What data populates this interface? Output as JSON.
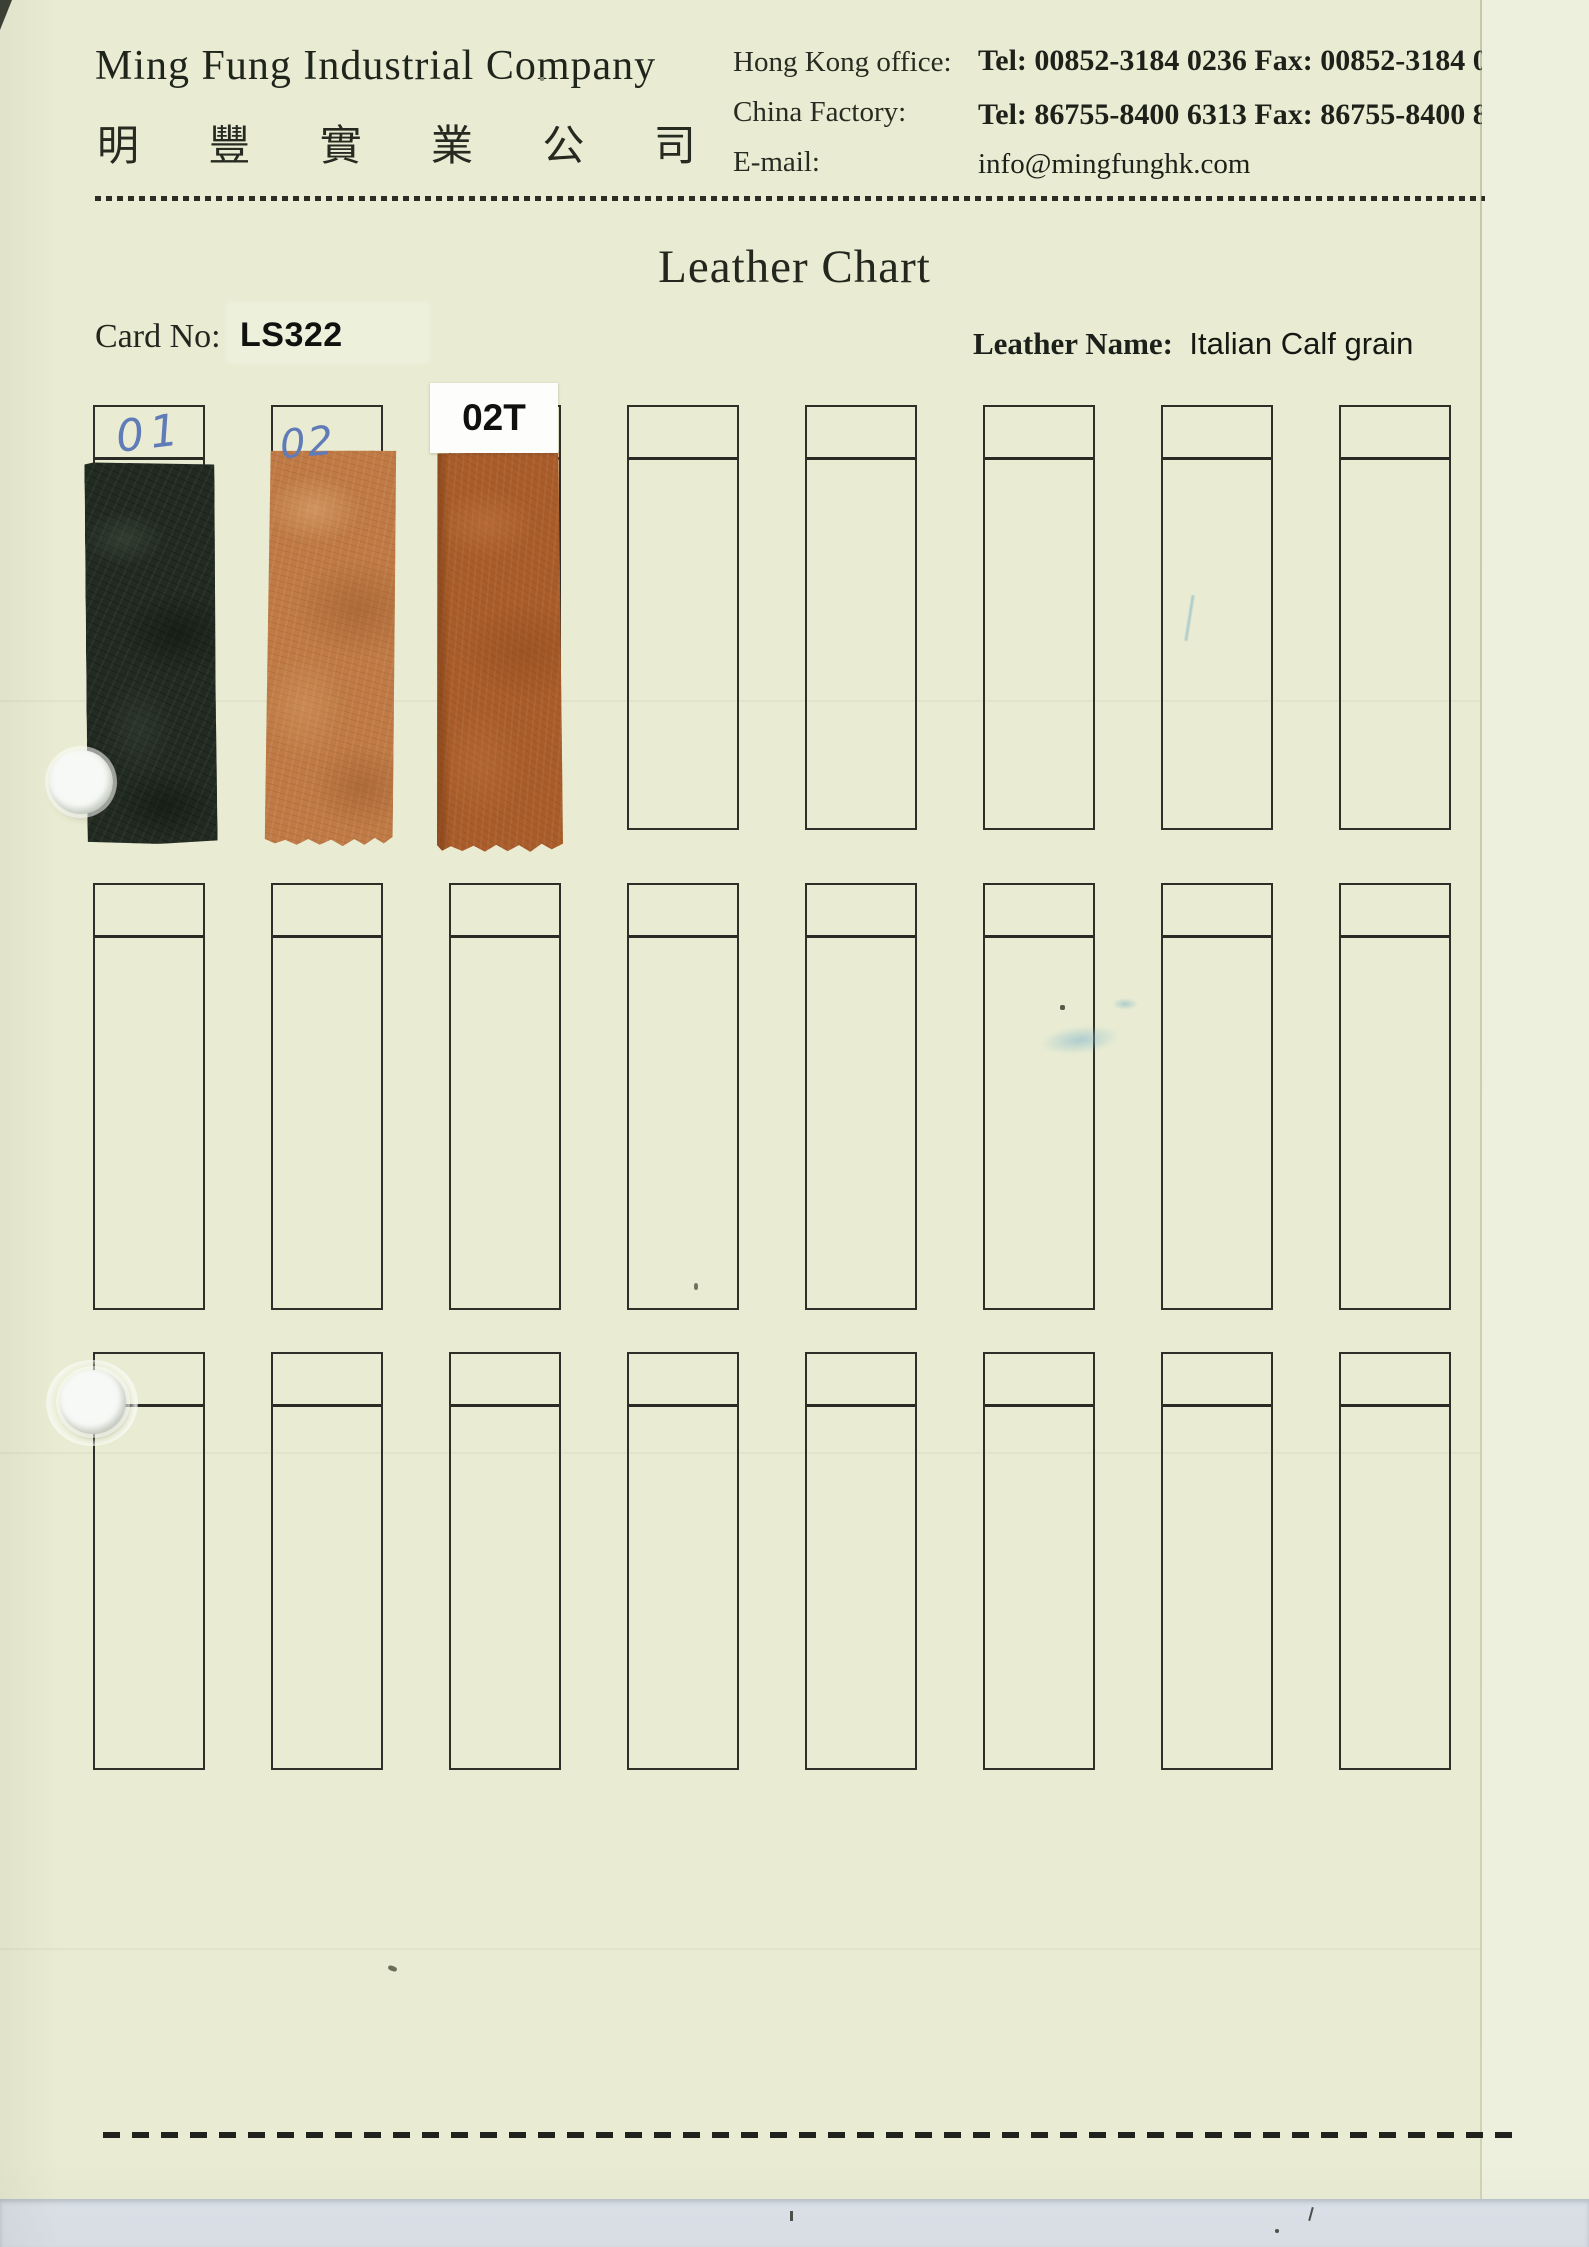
{
  "header": {
    "company_name_en": "Ming Fung Industrial Company",
    "company_name_zh": "明 豐 實 業 公 司",
    "contacts": {
      "hong_kong_label": "Hong Kong office:",
      "hong_kong_value": "Tel: 00852-3184 0236  Fax: 00852-3184 0239",
      "china_label": "China Factory:",
      "china_value": "Tel: 86755-8400 6313 Fax: 86755-8400 8207",
      "email_label": "E-mail:",
      "email_value": "info@mingfunghk.com"
    }
  },
  "title": "Leather Chart",
  "card": {
    "label": "Card No:",
    "number": "LS322"
  },
  "leather": {
    "label": "Leather Name:",
    "name": "Italian Calf grain"
  },
  "grid": {
    "rows": 3,
    "columns": 8,
    "filled_slots": 3,
    "empty_slots": 21
  },
  "samples": [
    {
      "id": "01",
      "label": "01",
      "label_style": "handwritten-blue",
      "color": "#232c23",
      "description": "dark green-black leather swatch"
    },
    {
      "id": "02",
      "label": "02",
      "label_style": "handwritten-blue",
      "color": "#bf7a45",
      "description": "tan leather swatch"
    },
    {
      "id": "02T",
      "label": "02T",
      "label_style": "printed-white-sticker",
      "color": "#aa5d2a",
      "description": "rust brown leather swatch"
    }
  ],
  "colors": {
    "paper": "#e9ecd2",
    "grid_line": "#2e2f28",
    "handwriting_blue": "#5f7bb8",
    "sticker_white": "#fdfdfb",
    "scanner_strip": "#dce2e9"
  }
}
